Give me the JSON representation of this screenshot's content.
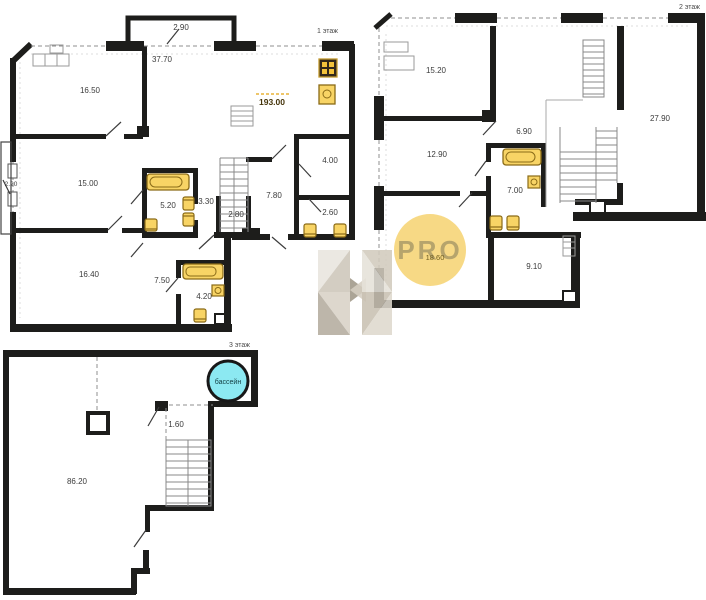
{
  "document": {
    "type": "apartment floor plans, 3 levels"
  },
  "floor1": {
    "label": "1 этаж",
    "areas": {
      "balcony_top": "2.90",
      "hall": "37.70",
      "room_1650": "16.50",
      "total": "193.00",
      "balcony_left": "2.20",
      "room_1500": "15.00",
      "bath_520": "5.20",
      "corr_330": "3.30",
      "stair_280": "2.80",
      "hall_780": "7.80",
      "room_400": "4.00",
      "wc_260": "2.60",
      "room_1640": "16.40",
      "corr_750": "7.50",
      "bath_420": "4.20"
    }
  },
  "floor2": {
    "label": "2 этаж",
    "areas": {
      "room_1520": "15.20",
      "terrace_2790": "27.90",
      "corr_690": "6.90",
      "room_1290": "12.90",
      "bath_700": "7.00",
      "room_1860": "18.60",
      "room_910": "9.10"
    }
  },
  "floor3": {
    "label": "3 этаж",
    "pool_label": "бассейн",
    "areas": {
      "corr_160": "1.60",
      "terrace_8620": "86.20"
    }
  },
  "watermarks": {
    "pro": "PRO",
    "logo": "H"
  },
  "icons": {
    "bathtub": "bathtub-icon",
    "toilet": "toilet-icon",
    "sink": "sink-icon",
    "stove": "stove-icon",
    "stairs": "stairs-icon",
    "pool": "pool-circle"
  },
  "colors": {
    "wall": "#1d1d1b",
    "fixture": "#f8d465",
    "fixture_stroke": "#8a6b17",
    "pool_fill": "#8ce9f2",
    "pro_circle": "#f6d67c",
    "highlight_dash": "#e8b339",
    "watermark_beige": "#d6cfc2"
  }
}
